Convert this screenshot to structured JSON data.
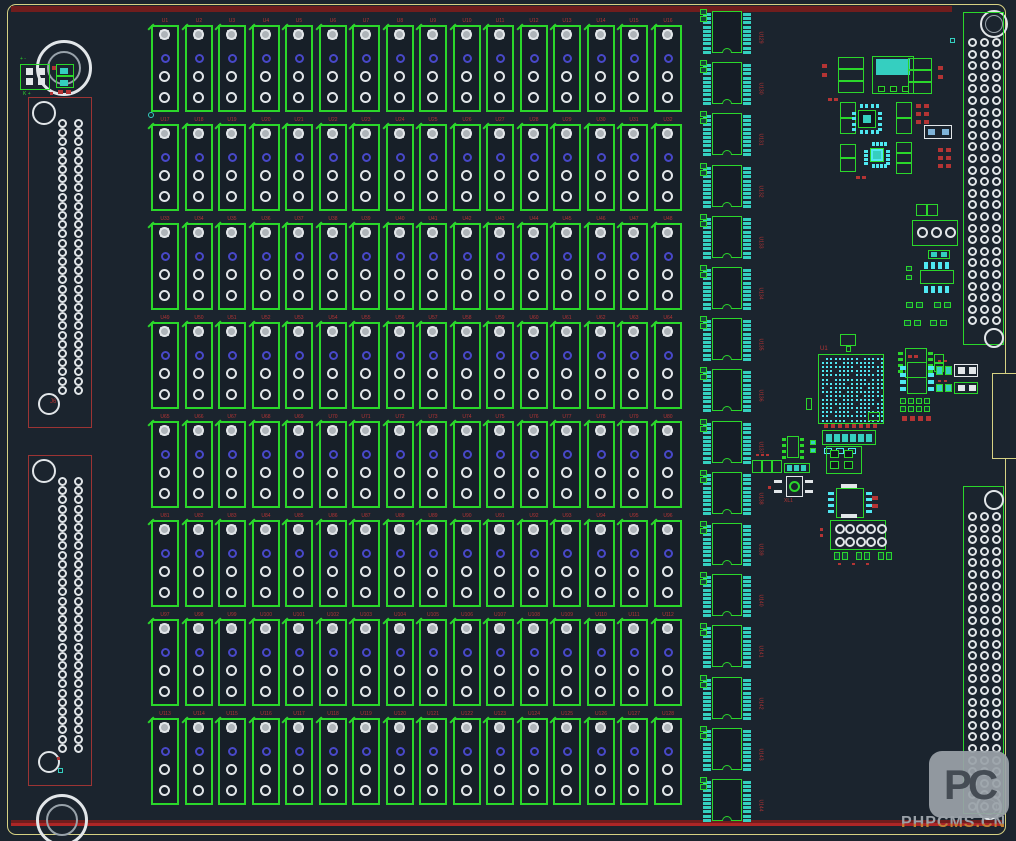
{
  "watermark": {
    "wordmark": "PHPCMS.CN",
    "logo_text": "PC"
  },
  "labels": {
    "left_connector_top": "J6",
    "bga": "U1",
    "crystal": "XL1",
    "tl_connector_top": "+ -",
    "tl_connector_bottom": "K +"
  },
  "relay_grid": {
    "rows": 8,
    "cols": 16,
    "labels": [
      [
        "U1",
        "U2",
        "U3",
        "U4",
        "U5",
        "U6",
        "U7",
        "U8",
        "U9",
        "U10",
        "U11",
        "U12",
        "U13",
        "U14",
        "U15",
        "U16"
      ],
      [
        "U17",
        "U18",
        "U19",
        "U20",
        "U21",
        "U22",
        "U23",
        "U24",
        "U25",
        "U26",
        "U27",
        "U28",
        "U29",
        "U30",
        "U31",
        "U32"
      ],
      [
        "U33",
        "U34",
        "U35",
        "U36",
        "U37",
        "U38",
        "U39",
        "U40",
        "U41",
        "U42",
        "U43",
        "U44",
        "U45",
        "U46",
        "U47",
        "U48"
      ],
      [
        "U49",
        "U50",
        "U51",
        "U52",
        "U53",
        "U54",
        "U55",
        "U56",
        "U57",
        "U58",
        "U59",
        "U60",
        "U61",
        "U62",
        "U63",
        "U64"
      ],
      [
        "U65",
        "U66",
        "U67",
        "U68",
        "U69",
        "U70",
        "U71",
        "U72",
        "U73",
        "U74",
        "U75",
        "U76",
        "U77",
        "U78",
        "U79",
        "U80"
      ],
      [
        "U81",
        "U82",
        "U83",
        "U84",
        "U85",
        "U86",
        "U87",
        "U88",
        "U89",
        "U90",
        "U91",
        "U92",
        "U93",
        "U94",
        "U95",
        "U96"
      ],
      [
        "U97",
        "U98",
        "U99",
        "U100",
        "U101",
        "U102",
        "U103",
        "U104",
        "U105",
        "U106",
        "U107",
        "U108",
        "U109",
        "U110",
        "U111",
        "U112"
      ],
      [
        "U113",
        "U114",
        "U115",
        "U116",
        "U117",
        "U118",
        "U119",
        "U120",
        "U121",
        "U122",
        "U123",
        "U124",
        "U125",
        "U126",
        "U127",
        "U128"
      ]
    ]
  },
  "dip_column": {
    "count": 16,
    "labels": [
      "U129",
      "U130",
      "U131",
      "U132",
      "U133",
      "U134",
      "U135",
      "U136",
      "U137",
      "U138",
      "U139",
      "U140",
      "U141",
      "U142",
      "U143",
      "U144"
    ]
  },
  "connectors": {
    "left": [
      {
        "pad_rows": 30,
        "pad_cols": 2
      },
      {
        "pad_rows": 30,
        "pad_cols": 2
      }
    ],
    "right": [
      {
        "pad_rows": 25,
        "pad_cols": 3
      },
      {
        "pad_rows": 26,
        "pad_cols": 3
      }
    ]
  },
  "colors": {
    "bg": "#1b242e",
    "edge": "#d6d183",
    "maroon": "#701d1d",
    "red_line": "#ad2626",
    "red": "#b43434",
    "conn_red": "#9c3434",
    "green": "#2bd72b",
    "teal": "#35cfc0",
    "cyan": "#4fe8f2",
    "white": "#e2e6e9",
    "blue": "#4848c8",
    "dark": "#10161d",
    "wm_gray": "#9aa1a8",
    "wm_dark": "#454c54",
    "wm_orange": "#c28036"
  }
}
